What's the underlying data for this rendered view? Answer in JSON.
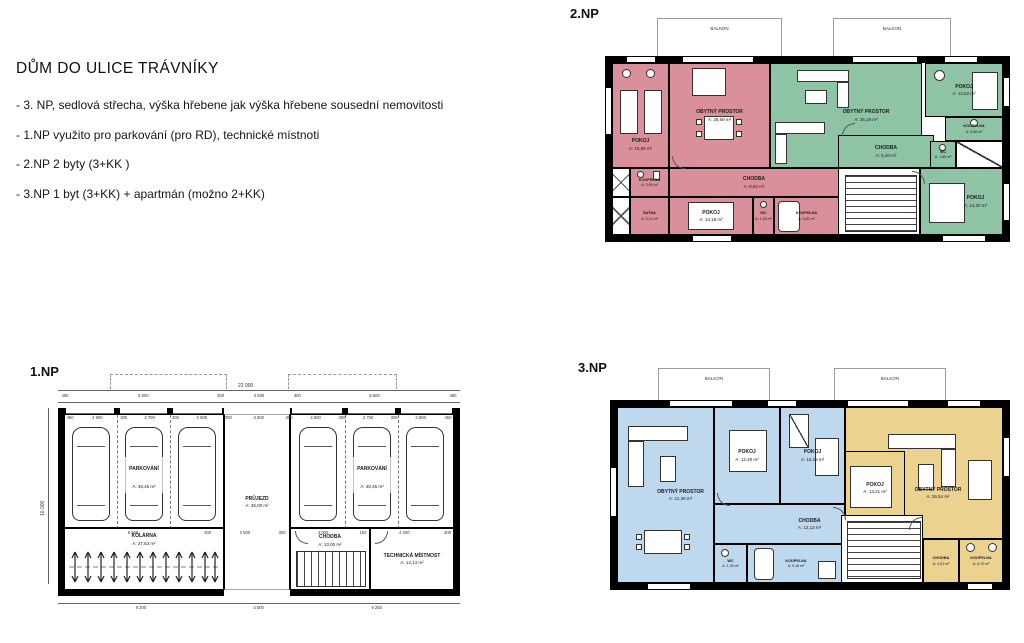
{
  "title_block": {
    "title": "DŮM DO ULICE TRÁVNÍKY",
    "bullets": [
      "- 3. NP, sedlová střecha, výška hřebene jak výška hřebene sousední nemovitosti",
      "- 1.NP využito pro parkování (pro RD), technické místnoti",
      "- 2.NP 2 byty (3+KK )",
      "- 3.NP 1 byt (3+KK) + apartmán (možno 2+KK)"
    ]
  },
  "colors": {
    "flat_red": "#d9909a",
    "flat_green": "#8ec4a5",
    "flat_blue": "#bed8ee",
    "flat_yellow": "#ecd28f",
    "wall": "#000000"
  },
  "floors": {
    "np2": {
      "label": "2.NP",
      "balkon_label": "BALKON",
      "rooms": {
        "pokoj1": {
          "name": "POKOJ",
          "area": "A: 16,65 m²"
        },
        "obytny": {
          "name": "OBYTNÝ PROSTOR",
          "area": "A: 28,69 m²"
        },
        "koupelna1": {
          "name": "KOUPELNA",
          "area": "A: 3,99 m²"
        },
        "satna": {
          "name": "ŠATNA",
          "area": "A: 4,14 m²"
        },
        "pokoj2": {
          "name": "POKOJ",
          "area": "A: 13,19 m²"
        },
        "chodba": {
          "name": "CHODBA",
          "area": "A: 8,83 m²"
        },
        "wc": {
          "name": "WC",
          "area": "A: 1,63 m²"
        },
        "koupelna2": {
          "name": "KOUPELNA",
          "area": "A: 5,80 m²"
        },
        "obytny_b": {
          "name": "OBYTNÝ PROSTOR",
          "area": "A: 36,19 m²"
        },
        "chodba_b": {
          "name": "CHODBA",
          "area": "A: 5,40 m²"
        },
        "pokoj_b1": {
          "name": "POKOJ",
          "area": "A: 13,62 m²"
        },
        "koupelna_b": {
          "name": "KOUPELNA",
          "area": "A: 5,06 m²"
        },
        "wc_b": {
          "name": "WC",
          "area": "A: 1,85 m²"
        },
        "pokoj_b2": {
          "name": "POKOJ",
          "area": "A: 14,30 m²"
        }
      }
    },
    "np3": {
      "label": "3.NP",
      "balkon_label": "BALKON",
      "rooms": {
        "obytny": {
          "name": "OBYTNÝ PROSTOR",
          "area": "A: 41,36 m²"
        },
        "pokoj1": {
          "name": "POKOJ",
          "area": "A: 12,48 m²"
        },
        "pokoj2": {
          "name": "POKOJ",
          "area": "A: 15,18 m²"
        },
        "chodba": {
          "name": "CHODBA",
          "area": "A: 12,13 m²"
        },
        "wc": {
          "name": "WC",
          "area": "A: 1,35 m²"
        },
        "koupelna": {
          "name": "KOUPELNA",
          "area": "A: 5,18 m²"
        },
        "pokoj_b": {
          "name": "POKOJ",
          "area": "A: 13,21 m²"
        },
        "obytny_b": {
          "name": "OBYTNÝ PROSTOR",
          "area": "A: 26,54 m²"
        },
        "chodba_b": {
          "name": "CHODBA",
          "area": "A: 4,51 m²"
        },
        "koupelna_b": {
          "name": "KOUPELNA",
          "area": "A: 6,72 m²"
        }
      }
    },
    "np1": {
      "label": "1.NP",
      "rooms": {
        "parkovani": {
          "name": "PARKOVÁNÍ",
          "area": "A: 48,45 m²"
        },
        "prujezd": {
          "name": "PRŮJEZD",
          "area": "A: 35,00 m²"
        },
        "kolarna": {
          "name": "KOLÁRNA",
          "area": "A: 27,63 m²"
        },
        "chodba": {
          "name": "CHODBA",
          "area": "A: 13,00 m²"
        },
        "technicka": {
          "name": "TECHNICKÁ MÍSTNOST",
          "area": "A: 14,14 m²"
        }
      },
      "dims": {
        "total_top": "22 000",
        "left_vertical": "10 000",
        "top_row": [
          {
            "t": "450",
            "w": 450
          },
          {
            "t": "8 500",
            "w": 8500
          },
          {
            "t": "300",
            "w": 300
          },
          {
            "t": "3 500",
            "w": 3500
          },
          {
            "t": "300",
            "w": 300
          },
          {
            "t": "8 500",
            "w": 8500
          },
          {
            "t": "450",
            "w": 450
          }
        ],
        "stall_row": [
          {
            "t": "450",
            "w": 450
          },
          {
            "t": "2 800",
            "w": 2800
          },
          {
            "t": "300",
            "w": 300
          },
          {
            "t": "2 700",
            "w": 2700
          },
          {
            "t": "300",
            "w": 300
          },
          {
            "t": "2 800",
            "w": 2800
          },
          {
            "t": "300",
            "w": 300
          },
          {
            "t": "3 500",
            "w": 3500
          },
          {
            "t": "300",
            "w": 300
          },
          {
            "t": "2 800",
            "w": 2800
          },
          {
            "t": "300",
            "w": 300
          },
          {
            "t": "2 750",
            "w": 2750
          },
          {
            "t": "300",
            "w": 300
          },
          {
            "t": "2 800",
            "w": 2800
          },
          {
            "t": "450",
            "w": 450
          }
        ],
        "mid_row": [
          {
            "t": "8 500",
            "w": 8500
          },
          {
            "t": "300",
            "w": 300
          },
          {
            "t": "3 500",
            "w": 3500
          },
          {
            "t": "300",
            "w": 300
          },
          {
            "t": "4 000",
            "w": 4000
          },
          {
            "t": "150",
            "w": 150
          },
          {
            "t": "4 200",
            "w": 4200
          },
          {
            "t": "400",
            "w": 400
          }
        ],
        "bottom_row": [
          {
            "t": "9 200",
            "w": 9200
          },
          {
            "t": "3 500",
            "w": 3500
          },
          {
            "t": "9 250",
            "w": 9250
          }
        ]
      }
    }
  }
}
